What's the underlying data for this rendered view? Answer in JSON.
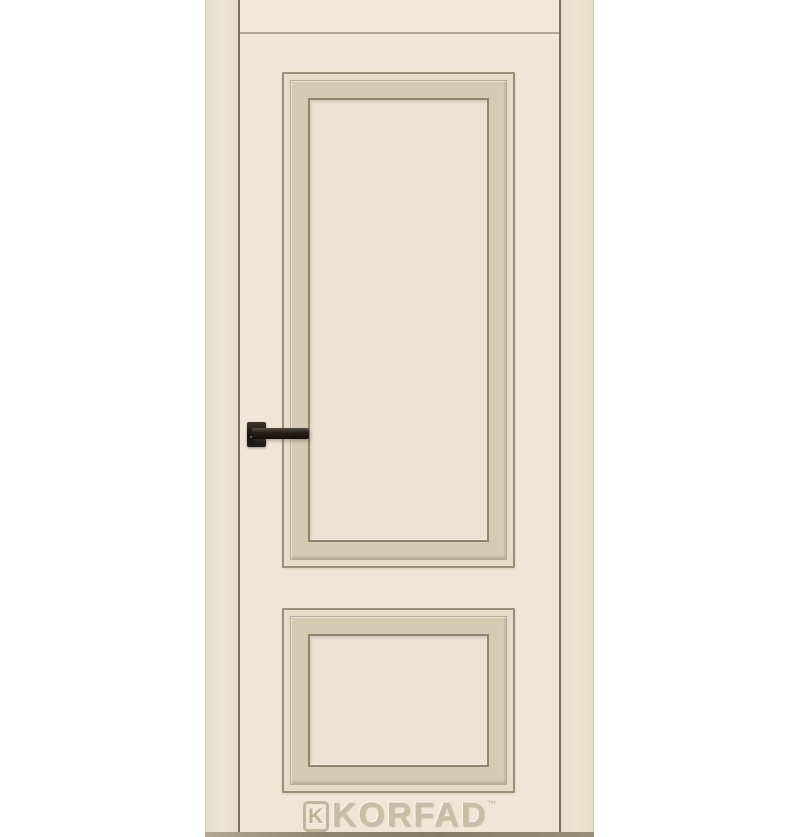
{
  "image": {
    "subject": "cream two-panel interior door with frame and black lever handle",
    "watermark": {
      "monogram": "K",
      "brand": "KORFAD",
      "trademark": "™"
    },
    "door": {
      "panel_count": 2,
      "upper_panel": "large recessed rectangular panel with stepped molding",
      "lower_panel": "small recessed rectangular panel with stepped molding",
      "handle": "black square-rosette lever handle on left stile"
    },
    "colors": {
      "background": "#ffffff",
      "door_leaf": "#f0e6d7",
      "head_band": "#f2e8d9",
      "head_line": "#b1a592",
      "frame_casing": "#e8ddcb",
      "frame_casing_light": "#efe5d5",
      "leaf_edge_line": "#7c7161",
      "casing_outer_line": "#d3c9ba",
      "molding_outer_line": "#9b8f78",
      "molding_step": "#e7dccb",
      "molding_band": "#d6cab5",
      "molding_band_line": "#b7ab94",
      "molding_inner_line": "#8f8470",
      "panel_field": "#ece2d3",
      "handle_dark": "#16120e",
      "handle_mid": "#3b342c",
      "watermark_text": "#c8bda7",
      "watermark_outline": "#baad96",
      "floor_shadow": "#8f8372"
    }
  }
}
